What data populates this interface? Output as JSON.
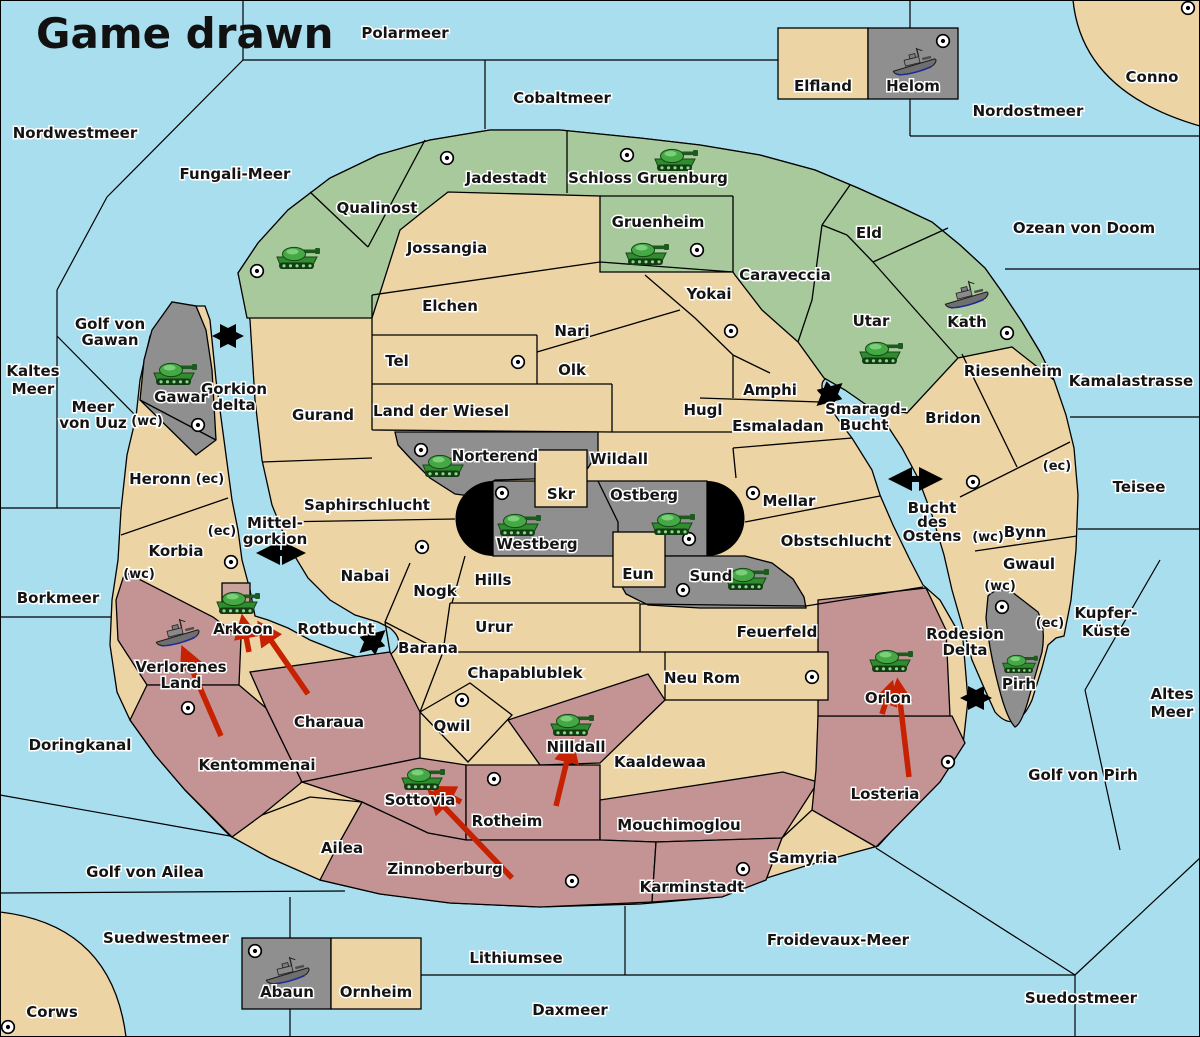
{
  "title": "Game drawn",
  "colors": {
    "sea": "#A9DEEF",
    "neutral_land": "#ECD4A5",
    "green_power": "#A7C99C",
    "gray_power": "#8F8F8F",
    "red_power": "#C49494",
    "impassable": "#000000",
    "order_arrow": "#C62100"
  },
  "labels": {
    "polarmeer": "Polarmeer",
    "nordwestmeer": "Nordwestmeer",
    "cobaltmeer": "Cobaltmeer",
    "nordostmeer": "Nordostmeer",
    "fungali_meer": "Fungali-Meer",
    "ozean_von_doom": "Ozean von Doom",
    "kamalastrasse": "Kamalastrasse",
    "teisee": "Teisee",
    "kupfer1": "Kupfer-",
    "kupfer2": "Küste",
    "altes1": "Altes",
    "altes2": "Meer",
    "golf_von_pirh": "Golf von Pirh",
    "kaltes1": "Kaltes",
    "kaltes2": "Meer",
    "golf_von_gawan1": "Golf von",
    "golf_von_gawan2": "Gawan",
    "meer_von_uuz1": "Meer",
    "meer_von_uuz2": "von Uuz",
    "gorkion_delta1": "Gorkion",
    "gorkion_delta2": "delta",
    "mittel1": "Mittel-",
    "mittel2": "gorkion",
    "smaragd1": "Smaragd-",
    "smaragd2": "Bucht",
    "bucht1": "Bucht",
    "bucht2": "des",
    "bucht3": "Ostens",
    "rotbucht": "Rotbucht",
    "borkmeer": "Borkmeer",
    "doringkanal": "Doringkanal",
    "golf_von_ailea": "Golf von Ailea",
    "suedwestmeer": "Suedwestmeer",
    "lithiumsee": "Lithiumsee",
    "daxmeer": "Daxmeer",
    "froidevaux_meer": "Froidevaux-Meer",
    "suedostmeer": "Suedostmeer",
    "rodesion1": "Rodesion",
    "rodesion2": "Delta",
    "conno": "Conno",
    "corws": "Corws",
    "jadestadt": "Jadestadt",
    "schloss_gruenburg": "Schloss Gruenburg",
    "qualinost": "Qualinost",
    "jossangia": "Jossangia",
    "gruenheim": "Gruenheim",
    "eld": "Eld",
    "caraveccia": "Caraveccia",
    "yokai": "Yokai",
    "elchen": "Elchen",
    "nari": "Nari",
    "utar": "Utar",
    "kath": "Kath",
    "tel": "Tel",
    "olk": "Olk",
    "riesenheim": "Riesenheim",
    "gawar": "Gawar",
    "gurand": "Gurand",
    "land_der_wiesel": "Land der Wiesel",
    "hugl": "Hugl",
    "amphi": "Amphi",
    "esmaladan": "Esmaladan",
    "bridon": "Bridon",
    "heronn": "Heronn",
    "norterend": "Norterend",
    "wildall": "Wildall",
    "skr": "Skr",
    "ostberg": "Ostberg",
    "mellar": "Mellar",
    "saphirschlucht": "Saphirschlucht",
    "westberg": "Westberg",
    "obstschlucht": "Obstschlucht",
    "korbia": "Korbia",
    "bynn": "Bynn",
    "gwaul": "Gwaul",
    "nabai": "Nabai",
    "nogk": "Nogk",
    "hills": "Hills",
    "eun": "Eun",
    "sund": "Sund",
    "urur": "Urur",
    "feuerfeld": "Feuerfeld",
    "barana": "Barana",
    "arkoon": "Arkoon",
    "verlorenes1": "Verlorenes",
    "verlorenes2": "Land",
    "chapablublek": "Chapablublek",
    "neu_rom": "Neu Rom",
    "charaua": "Charaua",
    "qwil": "Qwil",
    "nilldall": "Nilldall",
    "kaaldewaa": "Kaaldewaa",
    "kentommenai": "Kentommenai",
    "orlon": "Orlon",
    "losteria": "Losteria",
    "sottovia": "Sottovia",
    "rotheim": "Rotheim",
    "mouchimoglou": "Mouchimoglou",
    "ailea": "Ailea",
    "samyria": "Samyria",
    "zinnoberburg": "Zinnoberburg",
    "karminstadt": "Karminstadt",
    "pirh": "Pirh",
    "elfland": "Elfland",
    "helom": "Helom",
    "abaun": "Abaun",
    "ornheim": "Ornheim",
    "coast_wc": "(wc)",
    "coast_ec": "(ec)"
  },
  "units": {
    "armies": [
      "Candolti",
      "Schloss Gruenburg",
      "Gruenheim",
      "Utar",
      "Gawar",
      "Norterend",
      "Westberg",
      "Ostberg",
      "Sund",
      "Arkoon",
      "Nilldall",
      "Sottovia",
      "Orlon",
      "Pirh"
    ],
    "fleets": [
      "Helom",
      "Kath",
      "Verlorenes Land",
      "Abaun"
    ]
  },
  "supply_centers": [
    "Jadestadt",
    "Schloss Gruenburg",
    "Gruenheim",
    "Candolti",
    "Kath",
    "Yokai",
    "Tel",
    "Gawar",
    "Norterend",
    "Westberg",
    "Ostberg",
    "Sund",
    "Mellar",
    "Bridon",
    "Pirh",
    "Nabai",
    "Korbia",
    "Kentommenai",
    "Qwil",
    "Neu Rom",
    "Rotheim",
    "Zinnoberburg",
    "Karminstadt",
    "Losteria",
    "Corws",
    "Conno",
    "Helom",
    "Abaun"
  ],
  "strait_links": [
    "Gorkion delta",
    "Mittel-gorkion",
    "Smaragd-Bucht",
    "Bucht des Ostens",
    "Rotbucht",
    "Rodesion Delta"
  ],
  "move_arrows": [
    {
      "to": "Verlorenes Land"
    },
    {
      "to": "Arkoon"
    },
    {
      "to": "Arkoon"
    },
    {
      "to": "Nilldall"
    },
    {
      "to": "Sottovia"
    },
    {
      "to": "Sottovia"
    },
    {
      "to": "Orlon"
    },
    {
      "to": "Orlon"
    }
  ]
}
